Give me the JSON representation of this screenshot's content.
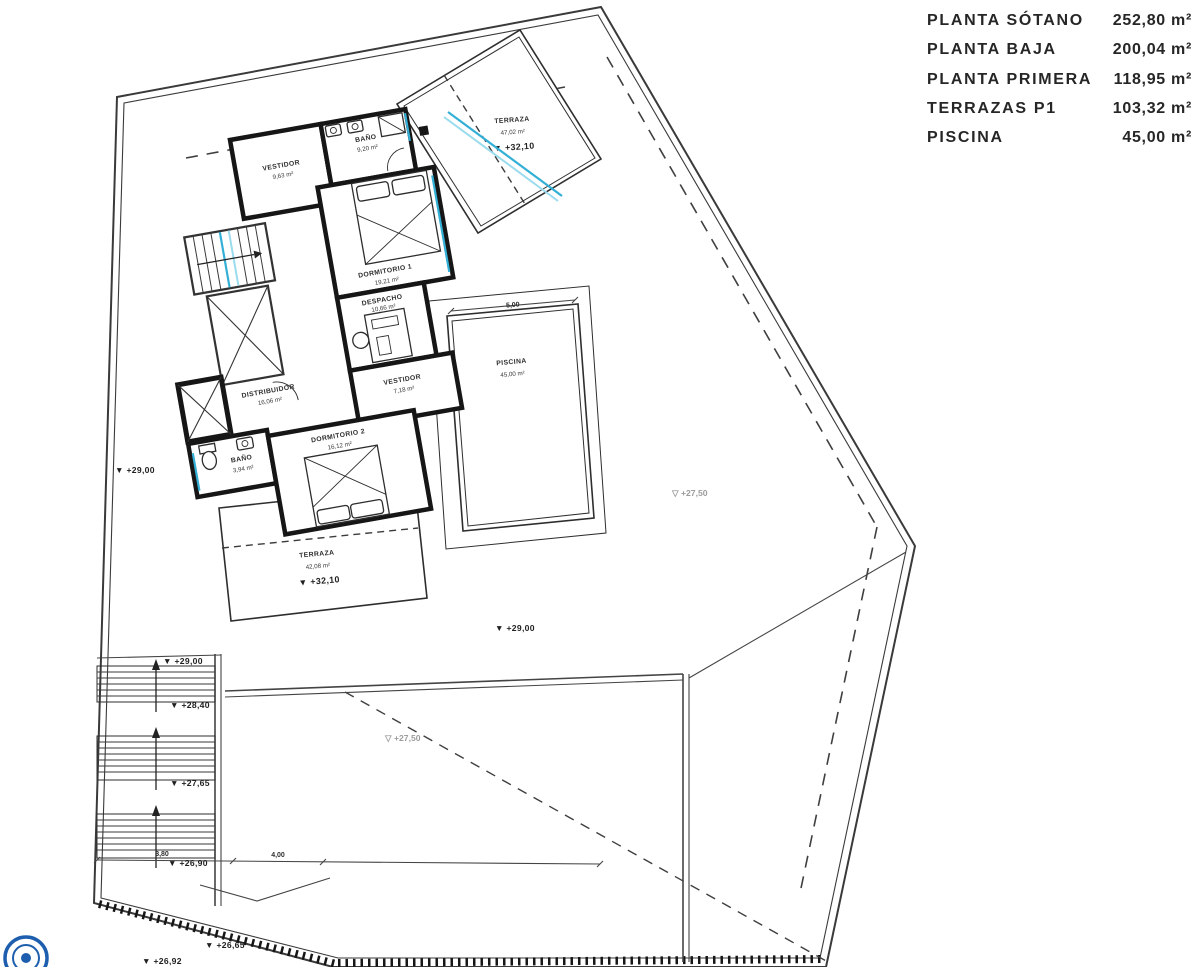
{
  "legend": {
    "rows": [
      {
        "label": "PLANTA SÓTANO",
        "value": "252,80 m²"
      },
      {
        "label": "PLANTA BAJA",
        "value": "200,04 m²"
      },
      {
        "label": "PLANTA PRIMERA",
        "value": "118,95 m²"
      },
      {
        "label": "TERRAZAS P1",
        "value": "103,32 m²"
      },
      {
        "label": "PISCINA",
        "value": "45,00 m²"
      }
    ]
  },
  "rooms": [
    {
      "name": "VESTIDOR",
      "area": "9,63 m²"
    },
    {
      "name": "BAÑO",
      "area": "9,20 m²"
    },
    {
      "name": "DORMITORIO 1",
      "area": "19,21 m²"
    },
    {
      "name": "DESPACHO",
      "area": "10,66 m²"
    },
    {
      "name": "DISTRIBUIDOR",
      "area": "16,06 m²"
    },
    {
      "name": "VESTIDOR",
      "area": "7,18 m²"
    },
    {
      "name": "BAÑO",
      "area": "3,94 m²"
    },
    {
      "name": "DORMITORIO 2",
      "area": "16,12 m²"
    }
  ],
  "terraces": [
    {
      "name": "TERRAZA",
      "area": "47,02 m²",
      "level": "▼ +32,10"
    },
    {
      "name": "TERRAZA",
      "area": "42,08 m²",
      "level": "▼ +32,10"
    }
  ],
  "pool": {
    "name": "PISCINA",
    "area": "45,00 m²",
    "dim_w": "5,00",
    "dim_l": "9,00"
  },
  "levels": [
    {
      "text": "▼ +29,00"
    },
    {
      "text": "▼ +29,00"
    },
    {
      "text": "▼ +28,40"
    },
    {
      "text": "▼ +27,65"
    },
    {
      "text": "▼ +26,90"
    },
    {
      "text": "▼ +26,65"
    },
    {
      "text": "▼ +26,92"
    },
    {
      "text": "▼ +29,00"
    },
    {
      "text": "▽ +27,50"
    },
    {
      "text": "▽ +27,50"
    }
  ],
  "dims": {
    "stair_a": "3,80",
    "stair_b": "4,00"
  },
  "colors": {
    "wall": "#161616",
    "line": "#3a3a3a",
    "dashed": "#3f3f3f",
    "glazing": "#34b0d6",
    "glazing_light": "#9adcee",
    "gray_label": "#9c9c9c",
    "legend_text": "#262626",
    "logo_blue": "#1d5fae"
  }
}
